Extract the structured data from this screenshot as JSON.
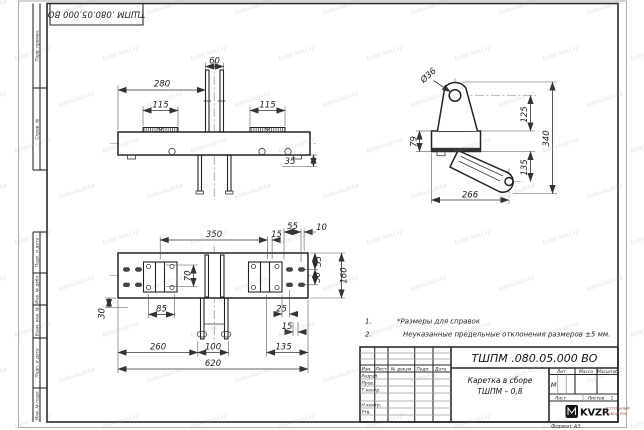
{
  "sheet": {
    "doc_stamp": "ТШПМ .080.05.000  ВО",
    "format_label": "Формат А3"
  },
  "margins": {
    "perv_primen": "Перв. примен.",
    "sprav_no": "Справ. №",
    "podp_data_1": "Подп. и дата",
    "inv_dubl": "Инв. № дубл.",
    "vzam_inv": "Взам. инв. №",
    "podp_data_2": "Подп. и дата",
    "inv_podl": "Инв. № подл."
  },
  "notes": {
    "n1_num": "1.",
    "n1_text": "*Размеры для справок",
    "n2_num": "2.",
    "n2_text": "Неуказанные предельные отклонения размеров  ±5 мм."
  },
  "dims": {
    "front_280": "280",
    "front_60": "60",
    "front_115_left": "115",
    "front_115_right": "115",
    "front_35": "35",
    "side_dia36": "Ø36",
    "side_125": "125",
    "side_340": "340",
    "side_79": "79",
    "side_135": "135",
    "side_266": "266",
    "top_350": "350",
    "top_15_upper": "15",
    "top_55_top": "55",
    "top_10": "10",
    "top_55_right": "55",
    "top_50_right": "50",
    "top_160": "160",
    "top_70": "70",
    "top_85": "85",
    "top_30": "30",
    "top_25": "25",
    "top_15_lower": "15",
    "top_260": "260",
    "top_100": "100",
    "top_135": "135",
    "top_620": "620"
  },
  "title_block": {
    "doc_number": "ТШПМ .080.05.000  ВО",
    "name_line1": "Каретка в сборе",
    "name_line2": "ТШПМ – 0,8",
    "col_izm": "Изм.",
    "col_list": "Лист",
    "col_ndoc": "№ докум.",
    "col_podp": "Подп.",
    "col_data": "Дата",
    "row_razrab": "Разраб.",
    "row_prov": "Пров.",
    "row_tkontr": "Т.контр.",
    "row_nkontr": "Н.контр.",
    "row_utv": "Утв.",
    "lit_label": "Лит.",
    "massa_label": "Масса",
    "masshtab_label": "Масштаб",
    "lit_value": "М",
    "list_label": "Лист",
    "listov_label": "Листов",
    "listov_value": "1",
    "logo_text": "KVZR",
    "logo_tagline1": "КОТЕЛЬНЫЙ",
    "logo_tagline2": "ЗАВОД РЭУ"
  },
  "watermark": {
    "text": "kotel-kvzr.kz"
  }
}
